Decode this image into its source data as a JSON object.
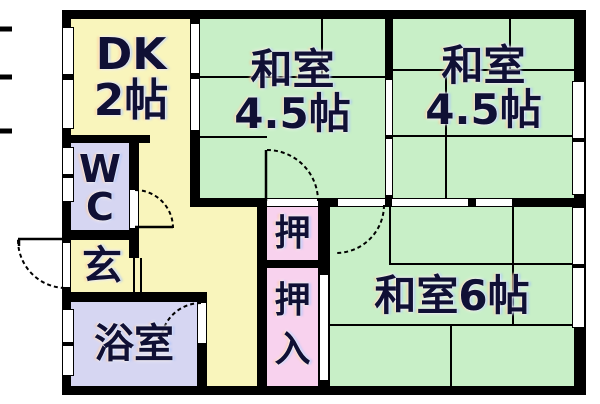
{
  "floorplan": {
    "type": "japanese-apartment-floorplan",
    "palette": {
      "wall": "#000000",
      "yellow": "#f9f5bc",
      "green": "#c8efc7",
      "lavender": "#d6d6f2",
      "pink": "#f8d2ee",
      "background": "#ffffff",
      "label": "#101035"
    },
    "rooms": [
      {
        "id": "dk",
        "lines": [
          "DK",
          "2帖"
        ]
      },
      {
        "id": "washitsu-mid",
        "lines": [
          "和室",
          "4.5帖"
        ]
      },
      {
        "id": "washitsu-right",
        "lines": [
          "和室",
          "4.5帖"
        ]
      },
      {
        "id": "washitsu-six",
        "lines": [
          "和室6帖"
        ]
      },
      {
        "id": "wc",
        "lines": [
          "W",
          "C"
        ]
      },
      {
        "id": "genkan",
        "lines": [
          "玄"
        ]
      },
      {
        "id": "bathroom",
        "lines": [
          "浴室"
        ]
      },
      {
        "id": "oshiire-upper",
        "lines": [
          "押"
        ]
      },
      {
        "id": "oshiire-lower",
        "lines": [
          "押",
          "入"
        ]
      }
    ]
  }
}
